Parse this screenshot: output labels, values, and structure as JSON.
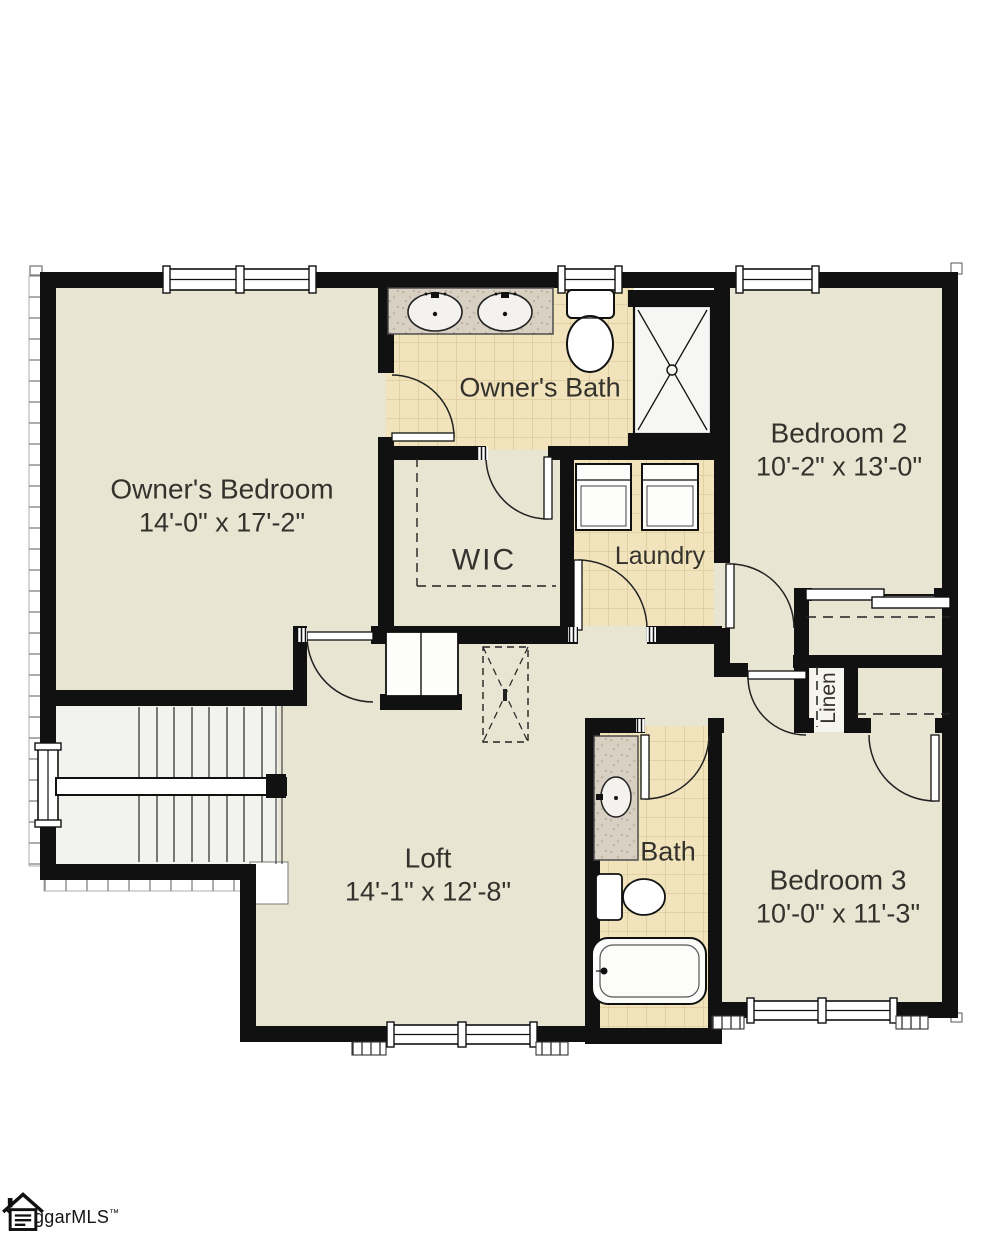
{
  "plan_title": "Second floor plan",
  "rooms": {
    "owners_bedroom": {
      "name": "Owner's Bedroom",
      "dims": "14'-0\" x 17'-2\""
    },
    "owners_bath": {
      "name": "Owner's Bath"
    },
    "wic": {
      "name": "WIC"
    },
    "laundry": {
      "name": "Laundry"
    },
    "bedroom2": {
      "name": "Bedroom 2",
      "dims": "10'-2\" x 13'-0\""
    },
    "linen": {
      "name": "Linen"
    },
    "bath": {
      "name": "Bath"
    },
    "bedroom3": {
      "name": "Bedroom 3",
      "dims": "10'-0\" x 11'-3\""
    },
    "loft": {
      "name": "Loft",
      "dims": "14'-1\" x 12'-8\""
    }
  },
  "fixtures": [
    "double-vanity-sinks",
    "toilet",
    "shower",
    "washer",
    "dryer",
    "single-vanity-sink",
    "bathtub",
    "staircase",
    "attic-access",
    "closet-rods",
    "windows"
  ],
  "watermark": {
    "text": "ggarMLS",
    "tm": "™"
  },
  "colors": {
    "carpet": "#e9e5d3",
    "tile": "#f1e4bc",
    "tile_line": "#d8c695",
    "granite": "#d8d1c3",
    "wall": "#111111",
    "stair_floor": "#f2f2ef"
  }
}
